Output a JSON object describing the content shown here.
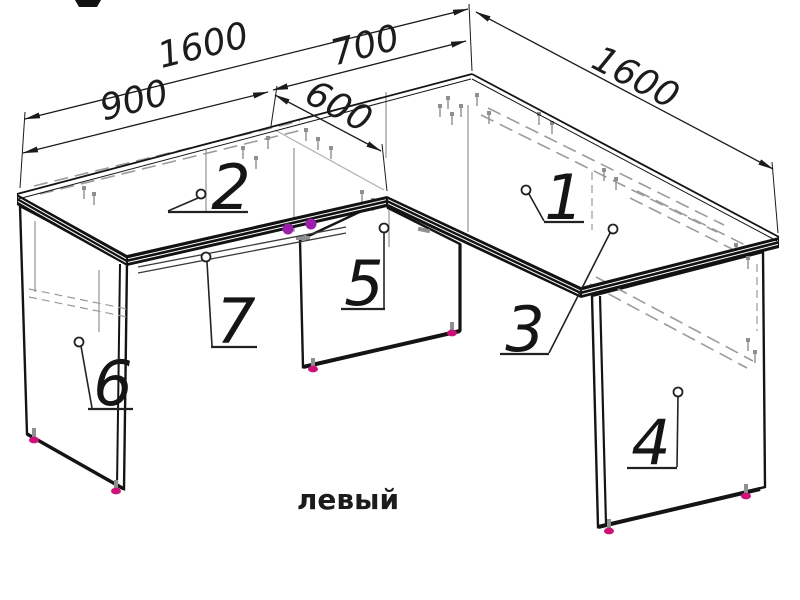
{
  "drawing": {
    "caption": "левый"
  },
  "dimensions": {
    "top_overall": "1600",
    "top_return": "700",
    "top_straight": "900",
    "wing_depth": "600",
    "right_side": "1600"
  },
  "parts": [
    "1",
    "2",
    "3",
    "4",
    "5",
    "6",
    "7"
  ],
  "colors": {
    "line": "#1a1a1a",
    "hardware_gray": "#9a9a9a",
    "cam_purple": "#9b1fa8",
    "foot_magenta": "#cc1277"
  }
}
